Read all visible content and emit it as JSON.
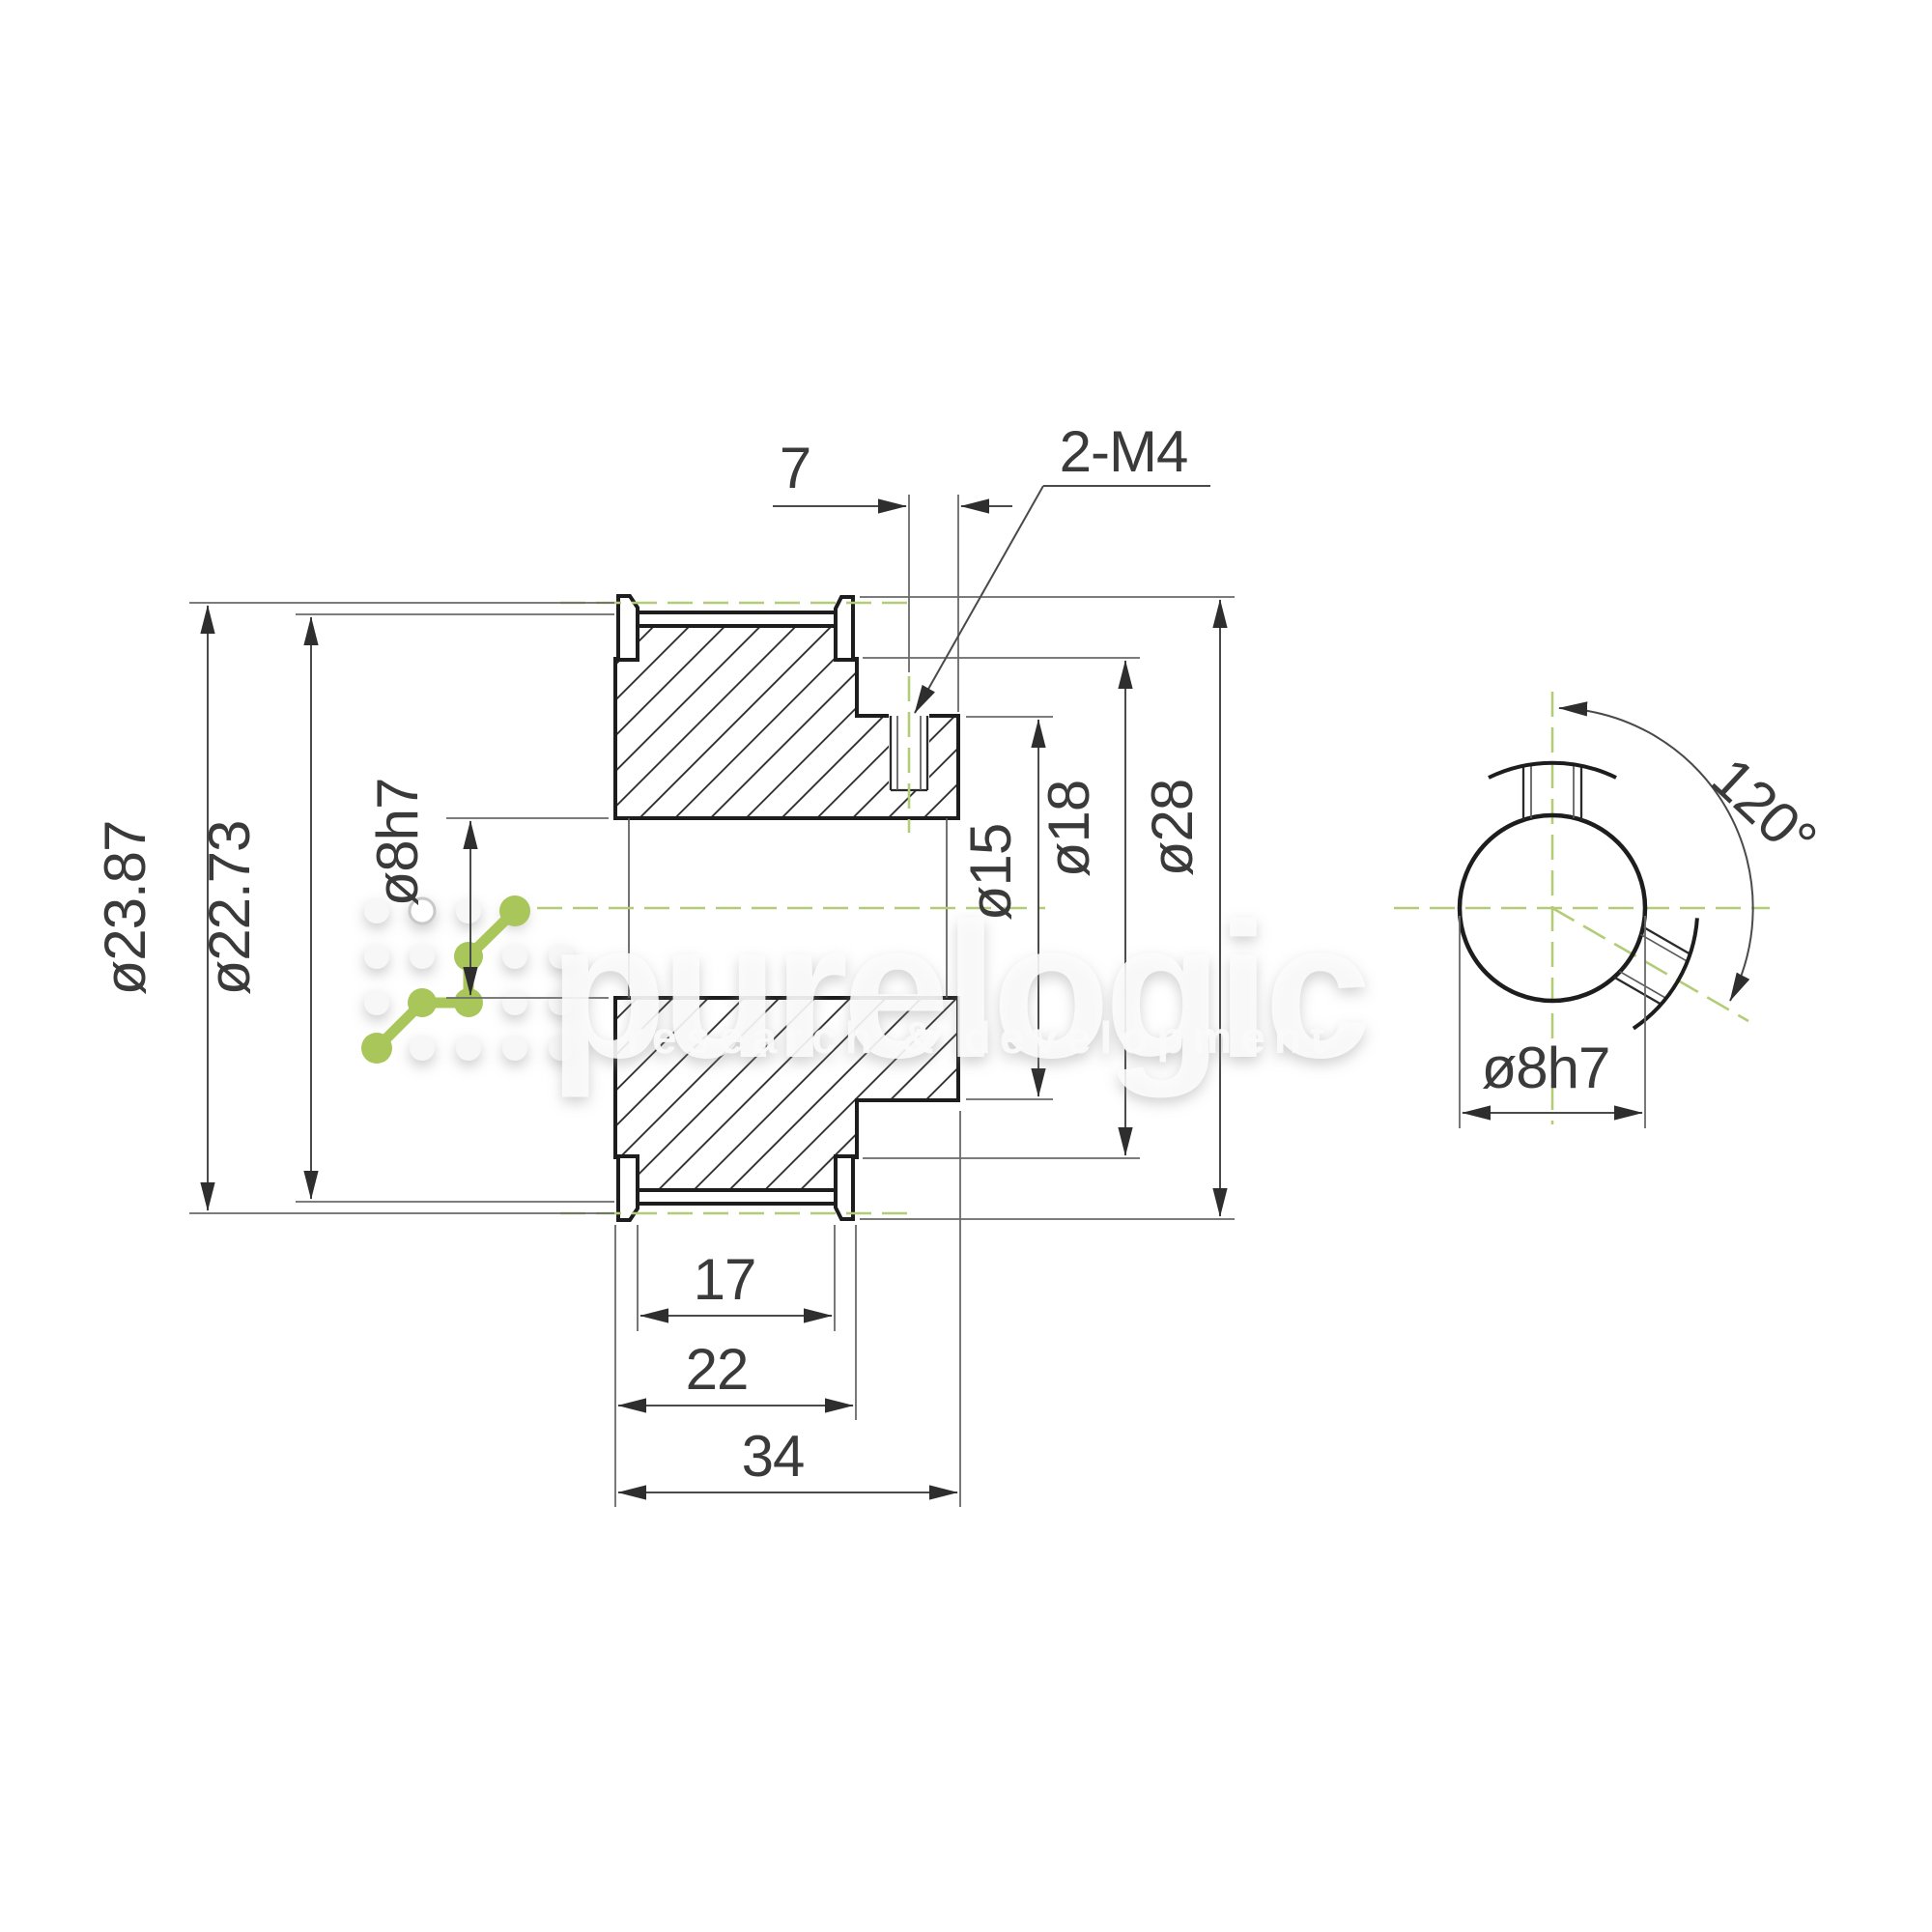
{
  "drawing_title": "timing pulley section drawing",
  "colors": {
    "background": "#ffffff",
    "outline": "#1d1d1d",
    "dimension_lines": "#4a4a4a",
    "centerline_green": "#b3cc78",
    "logo_green": "#a8c65a",
    "watermark_white": "#fafafa",
    "text": "#3a3a3a"
  },
  "watermark": {
    "brand": "purelogic",
    "tagline": "research & development"
  },
  "side_view": {
    "labels": {
      "pitch_diameter": "ø23.87",
      "outside_diameter": "ø22.73",
      "bore_diameter": "ø8h7",
      "boss_diameter": "ø15",
      "hub_step_diameter": "ø18",
      "flange_diameter": "ø28",
      "tooth_width": "17",
      "flange_width": "22",
      "overall_length": "34",
      "setscrew_offset": "7",
      "setscrew_spec": "2-M4"
    }
  },
  "end_view": {
    "labels": {
      "setscrew_angle": "120°",
      "bore_diameter": "ø8h7"
    }
  }
}
